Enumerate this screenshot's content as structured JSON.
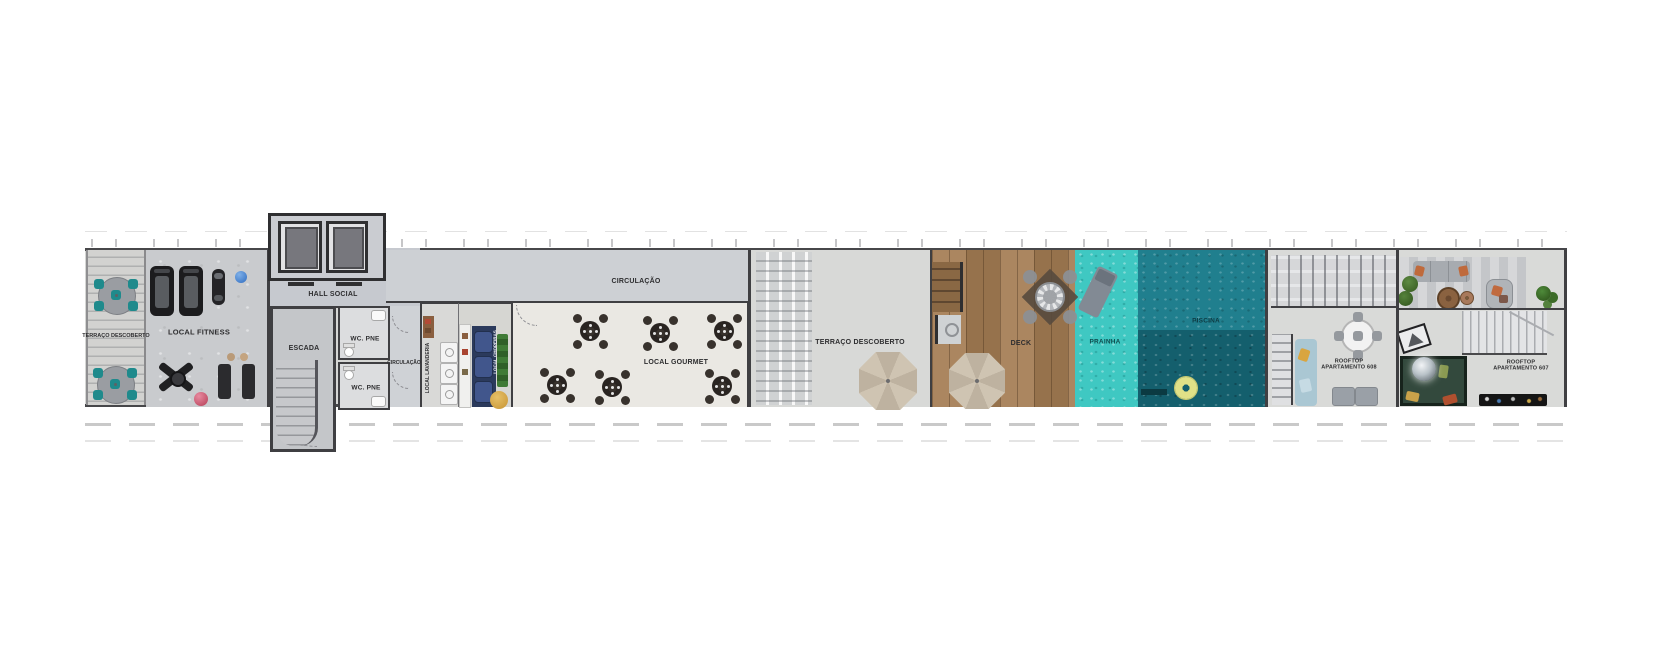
{
  "rooms": {
    "terraco_esquerda": {
      "label": "TERRAÇO DESCOBERTO"
    },
    "local_fitness": {
      "label": "LOCAL FITNESS"
    },
    "hall_social": {
      "label": "HALL SOCIAL"
    },
    "escada": {
      "label": "ESCADA"
    },
    "wc_pne_1": {
      "label": "WC. PNE"
    },
    "wc_pne_2": {
      "label": "WC. PNE"
    },
    "circulacao_wc": {
      "label": "CIRCULAÇÃO"
    },
    "local_lavanderia": {
      "label": "LOCAL LAVANDERIA"
    },
    "local_chopeiras": {
      "label": "LOCAL CHOPEIRAS"
    },
    "circulacao": {
      "label": "CIRCULAÇÃO"
    },
    "local_gourmet": {
      "label": "LOCAL GOURMET"
    },
    "terraco_central": {
      "label": "TERRAÇO DESCOBERTO"
    },
    "deck": {
      "label": "DECK"
    },
    "prainha": {
      "label": "PRAINHA"
    },
    "piscina": {
      "label": "PISCINA"
    },
    "rooftop_608": {
      "line1": "ROOFTOP",
      "line2": "APARTAMENTO 608"
    },
    "rooftop_607": {
      "line1": "ROOFTOP",
      "line2": "APARTAMENTO 607"
    }
  },
  "colors": {
    "pool_deep": "#145f6d",
    "pool": "#207f8e",
    "prainha": "#3fc8c2",
    "deck_wood": "#a57d54",
    "terrace_chair_teal": "#1f8a8c",
    "wall": "#3f3f42"
  }
}
